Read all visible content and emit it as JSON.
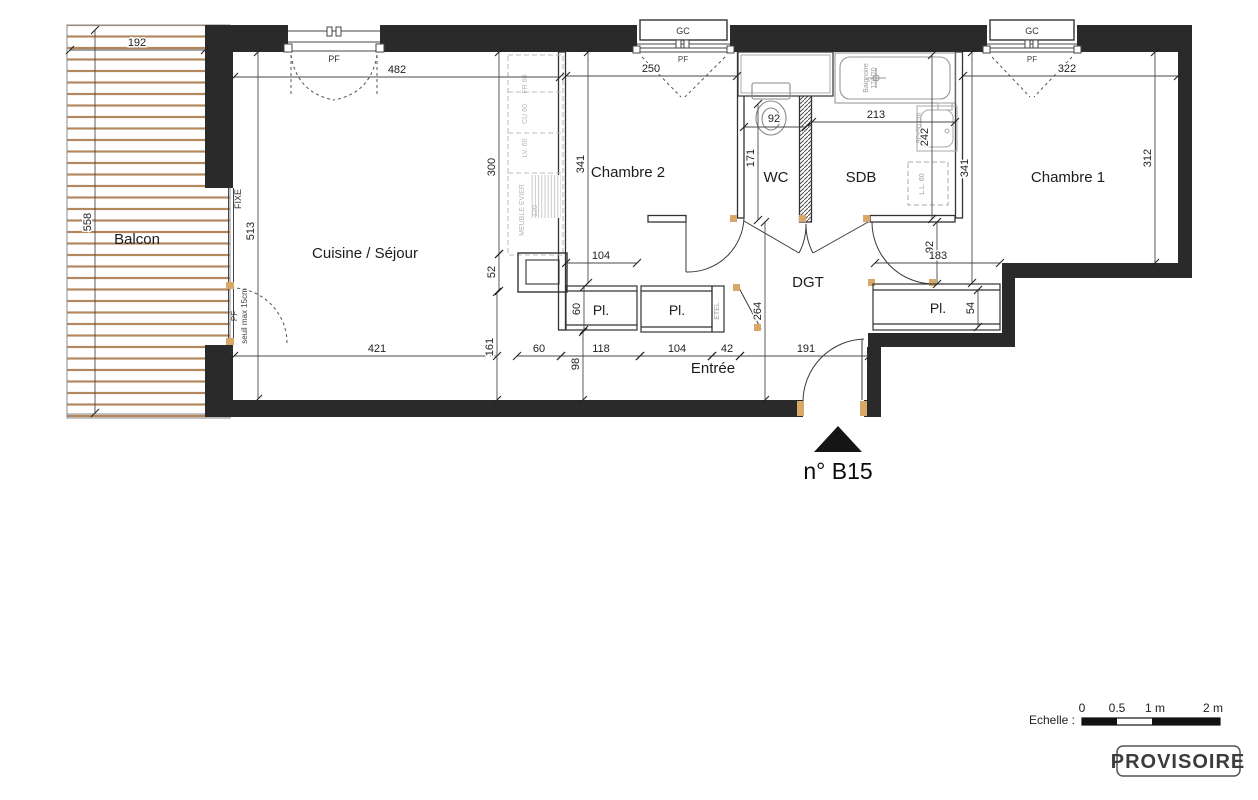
{
  "title": {
    "unit": "n° B15"
  },
  "rooms": {
    "balcon": "Balcon",
    "cuisine_sejour": "Cuisine / Séjour",
    "chambre2": "Chambre 2",
    "chambre1": "Chambre 1",
    "wc": "WC",
    "sdb": "SDB",
    "dgt": "DGT",
    "entree": "Entrée",
    "placard": "Pl."
  },
  "annotations": {
    "fixe": "FIXE",
    "pf": "PF",
    "seuil": "seuil max 15cm",
    "gc": "GC",
    "etel": "ETEL",
    "baignoire_line1": "Baignoire",
    "baignoire_line2": "170/70",
    "lavabo": "80x60 cm",
    "lave_linge": "L.L. 60",
    "frigo": "FR 60",
    "cuisson": "CU 60",
    "lave_vaisselle": "LV. 60",
    "meuble_evier": "MEUBLE EVIER",
    "meuble_evier_size": "120"
  },
  "dims": {
    "balcon_w": "192",
    "balcon_h": "558",
    "sejour_w": "482",
    "sejour_h": "513",
    "kitchen_h": "300",
    "kitchen_sq": "52",
    "ch2_h": "341",
    "ch2_w": "250",
    "pl1_top": "104",
    "pl1_d": "60",
    "wc_w": "92",
    "wc_h": "171",
    "sdb_w": "213",
    "sdb_h": "242",
    "ch1_h": "341",
    "ch1_w": "322",
    "ch1_e": "312",
    "dgt_h": "264",
    "ch1_door": "92",
    "pl3_w": "183",
    "pl3_d": "54",
    "bottom_1": "421",
    "bottom_v1": "161",
    "bottom_2": "60",
    "bottom_v2": "98",
    "bottom_3": "118",
    "bottom_4": "104",
    "bottom_5": "42",
    "bottom_6": "191"
  },
  "footer": {
    "scale_label": "Echelle :",
    "tick0": "0",
    "tick05": "0.5",
    "tick1": "1 m",
    "tick2": "2 m",
    "stamp": "PROVISOIRE"
  },
  "colors": {
    "wall": "#2b2a2b",
    "wood": "#b4885f",
    "jamb": "#d8a868",
    "fixture": "#9a9a9a"
  }
}
